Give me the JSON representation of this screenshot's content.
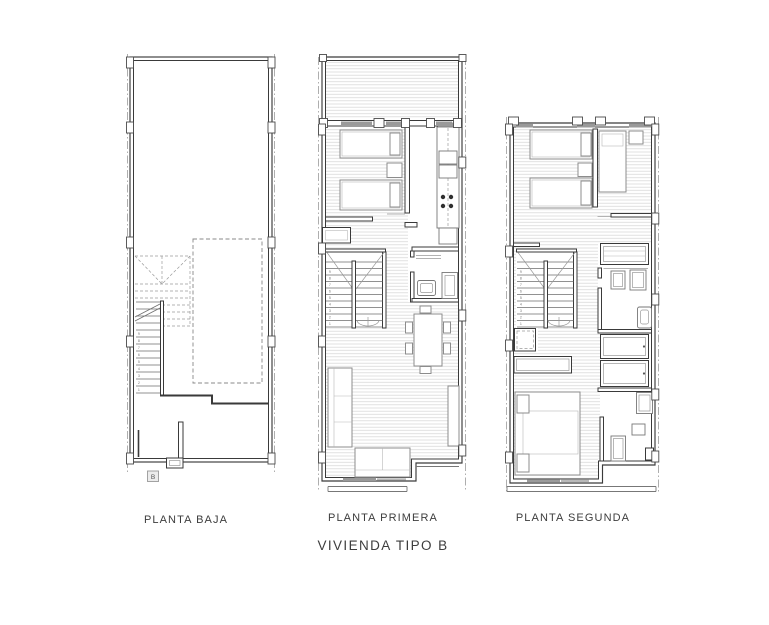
{
  "title": "VIVIENDA TIPO B",
  "plans": [
    {
      "id": "planta-baja",
      "label": "PLANTA BAJA"
    },
    {
      "id": "planta-primera",
      "label": "PLANTA PRIMERA"
    },
    {
      "id": "planta-segunda",
      "label": "PLANTA SEGUNDA"
    }
  ],
  "section_marker": "B",
  "stair_digits": [
    "1",
    "2",
    "3",
    "4",
    "5",
    "6",
    "7",
    "8",
    "9"
  ],
  "colors": {
    "wall": "#3a3a3a",
    "furniture": "#8c8c8c",
    "fixture": "#777777",
    "hatch": "#d9d9d9",
    "boundary_dash": "#9a9a9a",
    "window_fill": "#9a9a9a",
    "text": "#3d3d3d",
    "background": "#ffffff"
  }
}
